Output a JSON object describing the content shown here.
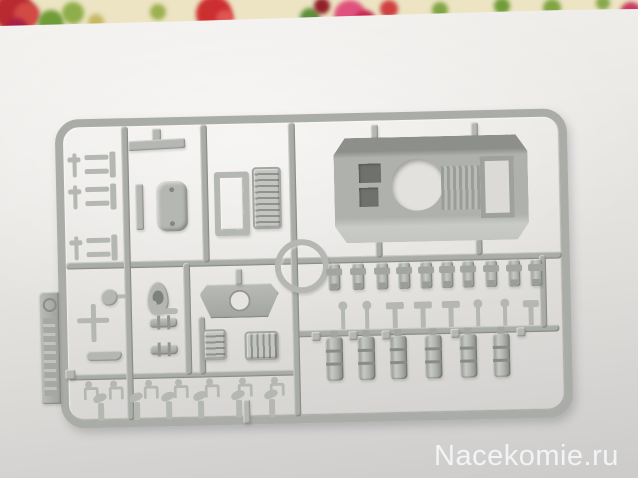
{
  "watermark": {
    "text": "Nacekomie.ru",
    "color": "#f4f6f8"
  },
  "colors": {
    "plastic": "#b4b7b2",
    "plastic_mid": "#a9aca7",
    "paper_light": "#f3f1ee",
    "paper_dark": "#cccbc9",
    "fabric_base": "#ece4c2"
  },
  "fabric": {
    "blobs": [
      {
        "x": -6,
        "y": -8,
        "r": 20,
        "c": "#b82a30"
      },
      {
        "x": 14,
        "y": 2,
        "r": 13,
        "c": "#d14a44"
      },
      {
        "x": 6,
        "y": 18,
        "r": 11,
        "c": "#a82048"
      },
      {
        "x": 38,
        "y": 10,
        "r": 13,
        "c": "#6f9c38"
      },
      {
        "x": 62,
        "y": 2,
        "r": 11,
        "c": "#8fae4a"
      },
      {
        "x": 88,
        "y": 14,
        "r": 8,
        "c": "#c8b864"
      },
      {
        "x": 150,
        "y": 4,
        "r": 8,
        "c": "#9cb050"
      },
      {
        "x": 196,
        "y": -4,
        "r": 18,
        "c": "#cc2f2f"
      },
      {
        "x": 216,
        "y": 10,
        "r": 9,
        "c": "#e05555"
      },
      {
        "x": 300,
        "y": 8,
        "r": 10,
        "c": "#5f8f3a"
      },
      {
        "x": 314,
        "y": -2,
        "r": 8,
        "c": "#8f1f28"
      },
      {
        "x": 334,
        "y": 0,
        "r": 16,
        "c": "#e0527e"
      },
      {
        "x": 354,
        "y": 10,
        "r": 11,
        "c": "#c62a50"
      },
      {
        "x": 380,
        "y": 0,
        "r": 9,
        "c": "#d04040"
      },
      {
        "x": 432,
        "y": 2,
        "r": 8,
        "c": "#7fa544"
      },
      {
        "x": 494,
        "y": -2,
        "r": 8,
        "c": "#6f9c38"
      },
      {
        "x": 543,
        "y": -1,
        "r": 9,
        "c": "#7fa544"
      },
      {
        "x": 596,
        "y": -4,
        "r": 7,
        "c": "#87a84c"
      },
      {
        "x": 620,
        "y": 2,
        "r": 11,
        "c": "#c83a62"
      }
    ]
  },
  "sprue": {
    "runners": [
      {
        "x": 8,
        "y": 143,
        "w": 496,
        "h": 7
      },
      {
        "x": 233,
        "y": 216,
        "w": 267,
        "h": 7
      },
      {
        "x": 8,
        "y": 255,
        "w": 228,
        "h": 6
      },
      {
        "x": 66,
        "y": 8,
        "w": 7,
        "h": 294
      },
      {
        "x": 145,
        "y": 8,
        "w": 7,
        "h": 138
      },
      {
        "x": 125,
        "y": 146,
        "w": 7,
        "h": 112
      },
      {
        "x": 233,
        "y": 8,
        "w": 7,
        "h": 294
      },
      {
        "x": 481,
        "y": 146,
        "w": 7,
        "h": 73
      },
      {
        "x": 139,
        "y": 200,
        "w": 7,
        "h": 58
      },
      {
        "x": 318,
        "y": 128,
        "w": 7,
        "h": 17
      },
      {
        "x": 418,
        "y": 128,
        "w": 7,
        "h": 17
      }
    ],
    "parts": [
      {
        "t": "tab",
        "x": -20,
        "y": 172,
        "w": 20,
        "h": 112
      },
      {
        "t": "hook",
        "x": 12,
        "y": 34,
        "w": 13,
        "h": 24
      },
      {
        "t": "bracket",
        "x": 29,
        "y": 33,
        "w": 31,
        "h": 26
      },
      {
        "t": "hook",
        "x": 12,
        "y": 66,
        "w": 13,
        "h": 24
      },
      {
        "t": "bracket",
        "x": 29,
        "y": 65,
        "w": 31,
        "h": 26
      },
      {
        "t": "hook",
        "x": 12,
        "y": 117,
        "w": 13,
        "h": 24
      },
      {
        "t": "bracket",
        "x": 29,
        "y": 116,
        "w": 31,
        "h": 26
      },
      {
        "t": "stub",
        "x": 97,
        "y": 11,
        "w": 9,
        "h": 12
      },
      {
        "t": "strip",
        "x": 73,
        "y": 22,
        "w": 57,
        "h": 10
      },
      {
        "t": "vstrip",
        "x": 79,
        "y": 66,
        "w": 8,
        "h": 46
      },
      {
        "t": "panel",
        "x": 100,
        "y": 64,
        "w": 31,
        "h": 50
      },
      {
        "t": "framering",
        "x": 158,
        "y": 56,
        "w": 23,
        "h": 52
      },
      {
        "t": "grille",
        "x": 196,
        "y": 52,
        "w": 25,
        "h": 58
      },
      {
        "t": "gate",
        "x": 316,
        "y": 12,
        "w": 7,
        "h": 14
      },
      {
        "t": "gate",
        "x": 416,
        "y": 12,
        "w": 7,
        "h": 14
      },
      {
        "t": "hull",
        "x": 278,
        "y": 25,
        "w": 194,
        "h": 105,
        "hole": {
          "x": 57,
          "y": 22,
          "w": 52,
          "h": 52
        },
        "o1": {
          "x": 25,
          "y": 26,
          "w": 22,
          "h": 19
        },
        "o2": {
          "x": 25,
          "y": 50,
          "w": 19,
          "h": 19
        },
        "ribs": {
          "x": 107,
          "y": 30,
          "w": 42,
          "h": 44
        },
        "rf": {
          "x": 146,
          "y": 21,
          "w": 24,
          "h": 52
        }
      },
      {
        "t": "ring",
        "x": 217,
        "y": 125,
        "w": 42,
        "h": 42
      },
      {
        "t": "disc",
        "x": 42,
        "y": 170,
        "w": 17,
        "h": 17
      },
      {
        "t": "cross",
        "x": 18,
        "y": 185,
        "w": 32,
        "h": 38
      },
      {
        "t": "arcbar",
        "x": 26,
        "y": 232,
        "w": 36,
        "h": 10
      },
      {
        "t": "cup",
        "x": 88,
        "y": 164,
        "w": 22,
        "h": 33
      },
      {
        "t": "tube",
        "x": 92,
        "y": 186,
        "w": 27,
        "h": 11
      },
      {
        "t": "flangecyl",
        "x": 90,
        "y": 200,
        "w": 28,
        "h": 10
      },
      {
        "t": "flangecyl",
        "x": 90,
        "y": 227,
        "w": 28,
        "h": 10
      },
      {
        "t": "plate",
        "x": 141,
        "y": 168,
        "w": 79,
        "h": 34
      },
      {
        "t": "gate",
        "x": 177,
        "y": 153,
        "w": 7,
        "h": 16
      },
      {
        "t": "grille",
        "x": 143,
        "y": 213,
        "w": 20,
        "h": 27
      },
      {
        "t": "grillev",
        "x": 185,
        "y": 216,
        "w": 30,
        "h": 25
      },
      {
        "t": "smallcyl",
        "x": 270,
        "y": 150,
        "w": 12,
        "h": 27
      },
      {
        "t": "smallcyl",
        "x": 294,
        "y": 150,
        "w": 12,
        "h": 27
      },
      {
        "t": "smallcyl",
        "x": 318,
        "y": 150,
        "w": 12,
        "h": 27
      },
      {
        "t": "smallcyl",
        "x": 340,
        "y": 150,
        "w": 12,
        "h": 27
      },
      {
        "t": "smallcyl",
        "x": 362,
        "y": 150,
        "w": 12,
        "h": 27
      },
      {
        "t": "smallcyl",
        "x": 383,
        "y": 150,
        "w": 12,
        "h": 27
      },
      {
        "t": "smallcyl",
        "x": 404,
        "y": 150,
        "w": 12,
        "h": 27
      },
      {
        "t": "smallcyl",
        "x": 427,
        "y": 150,
        "w": 12,
        "h": 27
      },
      {
        "t": "smallcyl",
        "x": 450,
        "y": 150,
        "w": 12,
        "h": 27
      },
      {
        "t": "smallcyl",
        "x": 472,
        "y": 150,
        "w": 12,
        "h": 27
      },
      {
        "t": "pin",
        "x": 279,
        "y": 188,
        "w": 10,
        "h": 28
      },
      {
        "t": "pin",
        "x": 303,
        "y": 188,
        "w": 10,
        "h": 28
      },
      {
        "t": "tcap",
        "x": 327,
        "y": 190,
        "w": 18,
        "h": 26
      },
      {
        "t": "tcap",
        "x": 355,
        "y": 190,
        "w": 18,
        "h": 26
      },
      {
        "t": "tcap",
        "x": 383,
        "y": 190,
        "w": 18,
        "h": 26
      },
      {
        "t": "pin",
        "x": 414,
        "y": 189,
        "w": 10,
        "h": 27
      },
      {
        "t": "pin",
        "x": 441,
        "y": 189,
        "w": 10,
        "h": 27
      },
      {
        "t": "tcap",
        "x": 464,
        "y": 191,
        "w": 16,
        "h": 25
      },
      {
        "t": "bigcyl",
        "x": 266,
        "y": 223,
        "w": 17,
        "h": 44
      },
      {
        "t": "bigcyl",
        "x": 298,
        "y": 223,
        "w": 17,
        "h": 44
      },
      {
        "t": "bigcyl",
        "x": 330,
        "y": 223,
        "w": 17,
        "h": 44
      },
      {
        "t": "bigcyl",
        "x": 365,
        "y": 223,
        "w": 17,
        "h": 44
      },
      {
        "t": "bigcyl",
        "x": 400,
        "y": 223,
        "w": 17,
        "h": 44
      },
      {
        "t": "bigcyl",
        "x": 433,
        "y": 223,
        "w": 17,
        "h": 44
      },
      {
        "t": "stub",
        "x": 252,
        "y": 218,
        "w": 9,
        "h": 9
      },
      {
        "t": "stub",
        "x": 289,
        "y": 218,
        "w": 9,
        "h": 9
      },
      {
        "t": "stub",
        "x": 322,
        "y": 218,
        "w": 9,
        "h": 9
      },
      {
        "t": "stub",
        "x": 391,
        "y": 218,
        "w": 9,
        "h": 9
      },
      {
        "t": "stub",
        "x": 457,
        "y": 218,
        "w": 9,
        "h": 9
      },
      {
        "t": "stub",
        "x": 5,
        "y": 250,
        "w": 10,
        "h": 10
      },
      {
        "t": "shackle",
        "x": 21,
        "y": 262,
        "w": 14,
        "h": 17
      },
      {
        "t": "shackle",
        "x": 46,
        "y": 262,
        "w": 14,
        "h": 17
      },
      {
        "t": "shackle",
        "x": 81,
        "y": 262,
        "w": 14,
        "h": 17
      },
      {
        "t": "shackle",
        "x": 111,
        "y": 262,
        "w": 14,
        "h": 17
      },
      {
        "t": "shackle",
        "x": 142,
        "y": 262,
        "w": 14,
        "h": 17
      },
      {
        "t": "shackle",
        "x": 175,
        "y": 262,
        "w": 14,
        "h": 17
      },
      {
        "t": "shackle",
        "x": 207,
        "y": 262,
        "w": 14,
        "h": 17
      },
      {
        "t": "scope",
        "x": 31,
        "y": 277,
        "w": 16,
        "h": 25
      },
      {
        "t": "scope",
        "x": 67,
        "y": 277,
        "w": 16,
        "h": 25
      },
      {
        "t": "scope",
        "x": 99,
        "y": 277,
        "w": 16,
        "h": 25
      },
      {
        "t": "scope",
        "x": 131,
        "y": 277,
        "w": 16,
        "h": 25
      },
      {
        "t": "scope",
        "x": 169,
        "y": 277,
        "w": 16,
        "h": 25
      },
      {
        "t": "scope",
        "x": 202,
        "y": 277,
        "w": 16,
        "h": 25
      },
      {
        "t": "gate",
        "x": 182,
        "y": 284,
        "w": 7,
        "h": 24
      }
    ]
  }
}
